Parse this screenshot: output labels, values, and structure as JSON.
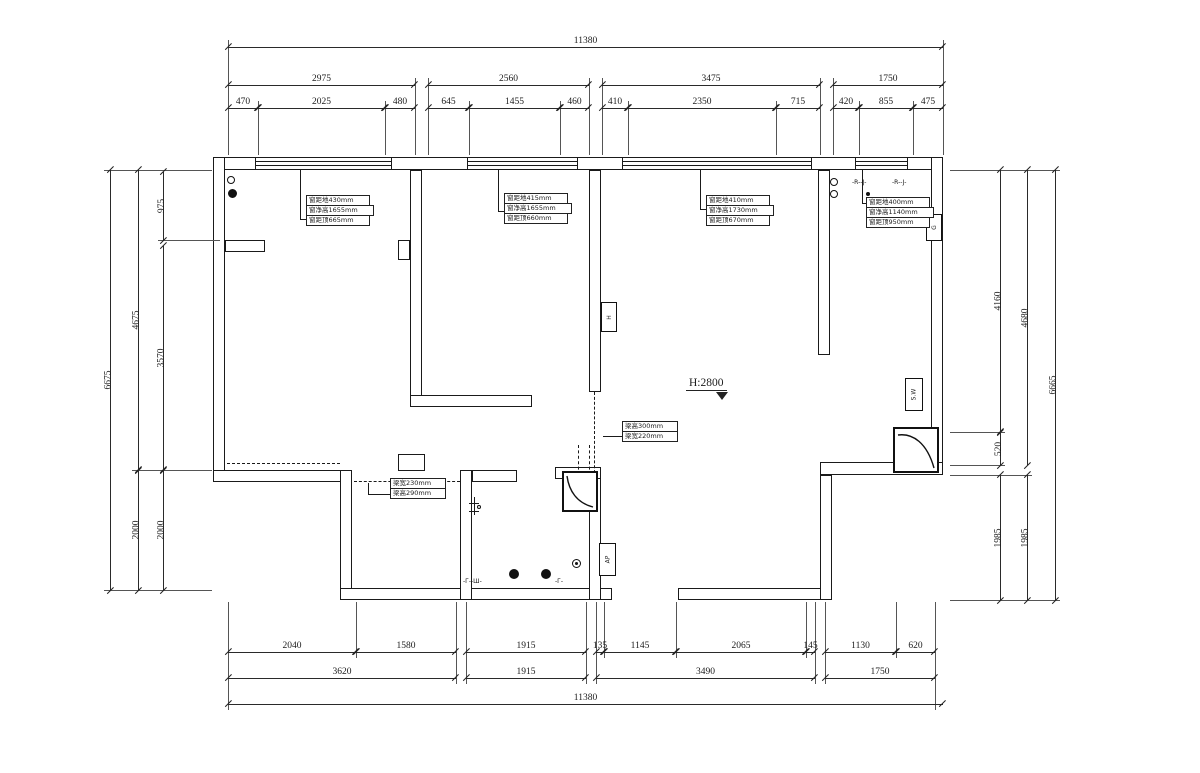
{
  "dims": {
    "top": {
      "total": "11380",
      "row2": [
        "2975",
        "2560",
        "3475",
        "1750"
      ],
      "row3": [
        "470",
        "2025",
        "480",
        "645",
        "1455",
        "460",
        "410",
        "2350",
        "715",
        "420",
        "855",
        "475"
      ]
    },
    "bottom": {
      "row1": [
        "2040",
        "1580",
        "1915",
        "135",
        "1145",
        "2065",
        "145",
        "1130",
        "620"
      ],
      "row2": [
        "3620",
        "1915",
        "3490",
        "1750"
      ],
      "total": "11380"
    },
    "left": {
      "outer": "6675",
      "mid": [
        "4675",
        "2000"
      ],
      "inner": [
        "975",
        "3570",
        "2000"
      ]
    },
    "right": {
      "inner": [
        "4160",
        "520",
        "1985"
      ],
      "mid": [
        "4680",
        "1985"
      ],
      "outer": "6665"
    }
  },
  "annotations": {
    "level": "H:2800",
    "windows": [
      {
        "line1": "窗距地430mm",
        "line2": "窗净高1655mm",
        "line3": "窗距顶665mm"
      },
      {
        "line1": "窗距地415mm",
        "line2": "窗净高1655mm",
        "line3": "窗距顶660mm"
      },
      {
        "line1": "窗距地410mm",
        "line2": "窗净高1730mm",
        "line3": "窗距顶670mm"
      },
      {
        "line1": "窗距地400mm",
        "line2": "窗净高1140mm",
        "line3": "窗距顶950mm"
      }
    ],
    "beams": [
      {
        "line1": "梁高300mm",
        "line2": "梁宽220mm"
      },
      {
        "line1": "梁宽230mm",
        "line2": "梁高290mm"
      }
    ],
    "boxes": {
      "h": "H",
      "ap": "AP",
      "sw": "S.W",
      "g": "G"
    },
    "marks": {
      "rj1": "-R--J-",
      "rj2": "-R--J-",
      "drain1": "-Г--Ш-",
      "drain2": "-Г-"
    }
  }
}
